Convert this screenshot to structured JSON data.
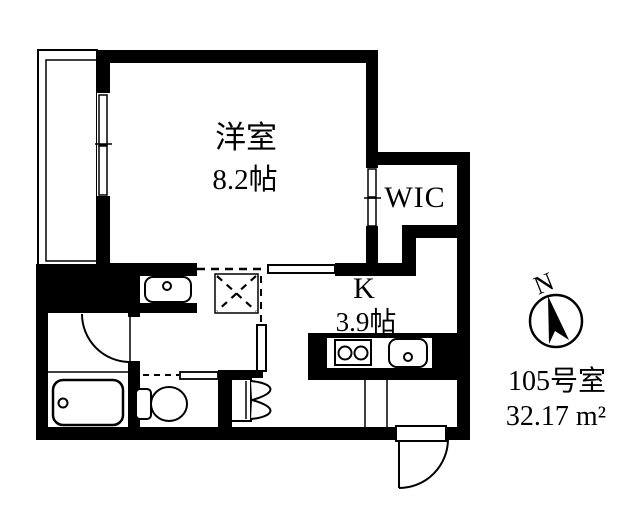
{
  "rooms": {
    "western_room": {
      "name": "洋室",
      "size": "8.2帖"
    },
    "wic": {
      "name": "WIC"
    },
    "kitchen": {
      "name": "K",
      "size": "3.9帖"
    }
  },
  "unit": {
    "room_number": "105号室",
    "floor_area": "32.17 m²"
  },
  "compass": {
    "north_label": "N"
  },
  "fixtures": [
    "balcony",
    "sliding-window",
    "wic-sliding-door",
    "washbasin",
    "washing-machine-space",
    "bathtub",
    "bath-door",
    "toilet",
    "folding-door",
    "gas-stove",
    "kitchen-sink",
    "entrance-door",
    "compass"
  ],
  "colors": {
    "line": "#000000",
    "background": "#ffffff"
  }
}
